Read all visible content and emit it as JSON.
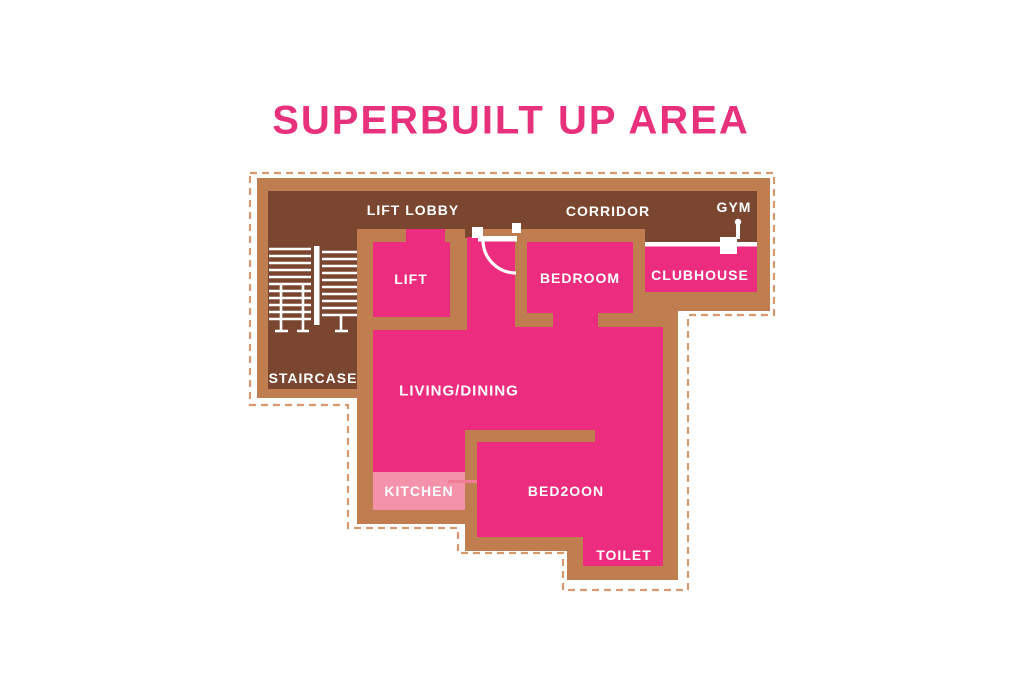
{
  "title": "SUPERBUILT UP AREA",
  "plan": {
    "areas": {
      "lift_lobby": "LIFT LOBBY",
      "corridor": "CORRIDOR",
      "gym": "GYM",
      "lift": "LIFT",
      "bedroom": "BEDROOM",
      "clubhouse": "CLUBHOUSE",
      "staircase": "STAIRCASE",
      "living_dining": "LIVING/DINING",
      "kitchen": "KITCHEN",
      "bedroom2": "BED2OON",
      "toilet": "TOILET"
    },
    "icons": {
      "staircase": "staircase-icon",
      "door_swing": "door-swing-icon",
      "gym_equipment": "gym-equipment-icon"
    }
  },
  "colors": {
    "title_pink": "#E8317D",
    "room_pink": "#EC2C7E",
    "kitchen_pink": "#F492AA",
    "kitchen_line": "#EF7D95",
    "floor_brown": "#7A4630",
    "wall_tan": "#BF7D50",
    "dashed_tan": "#D79A6F",
    "accent_white": "#FFFFFF"
  }
}
